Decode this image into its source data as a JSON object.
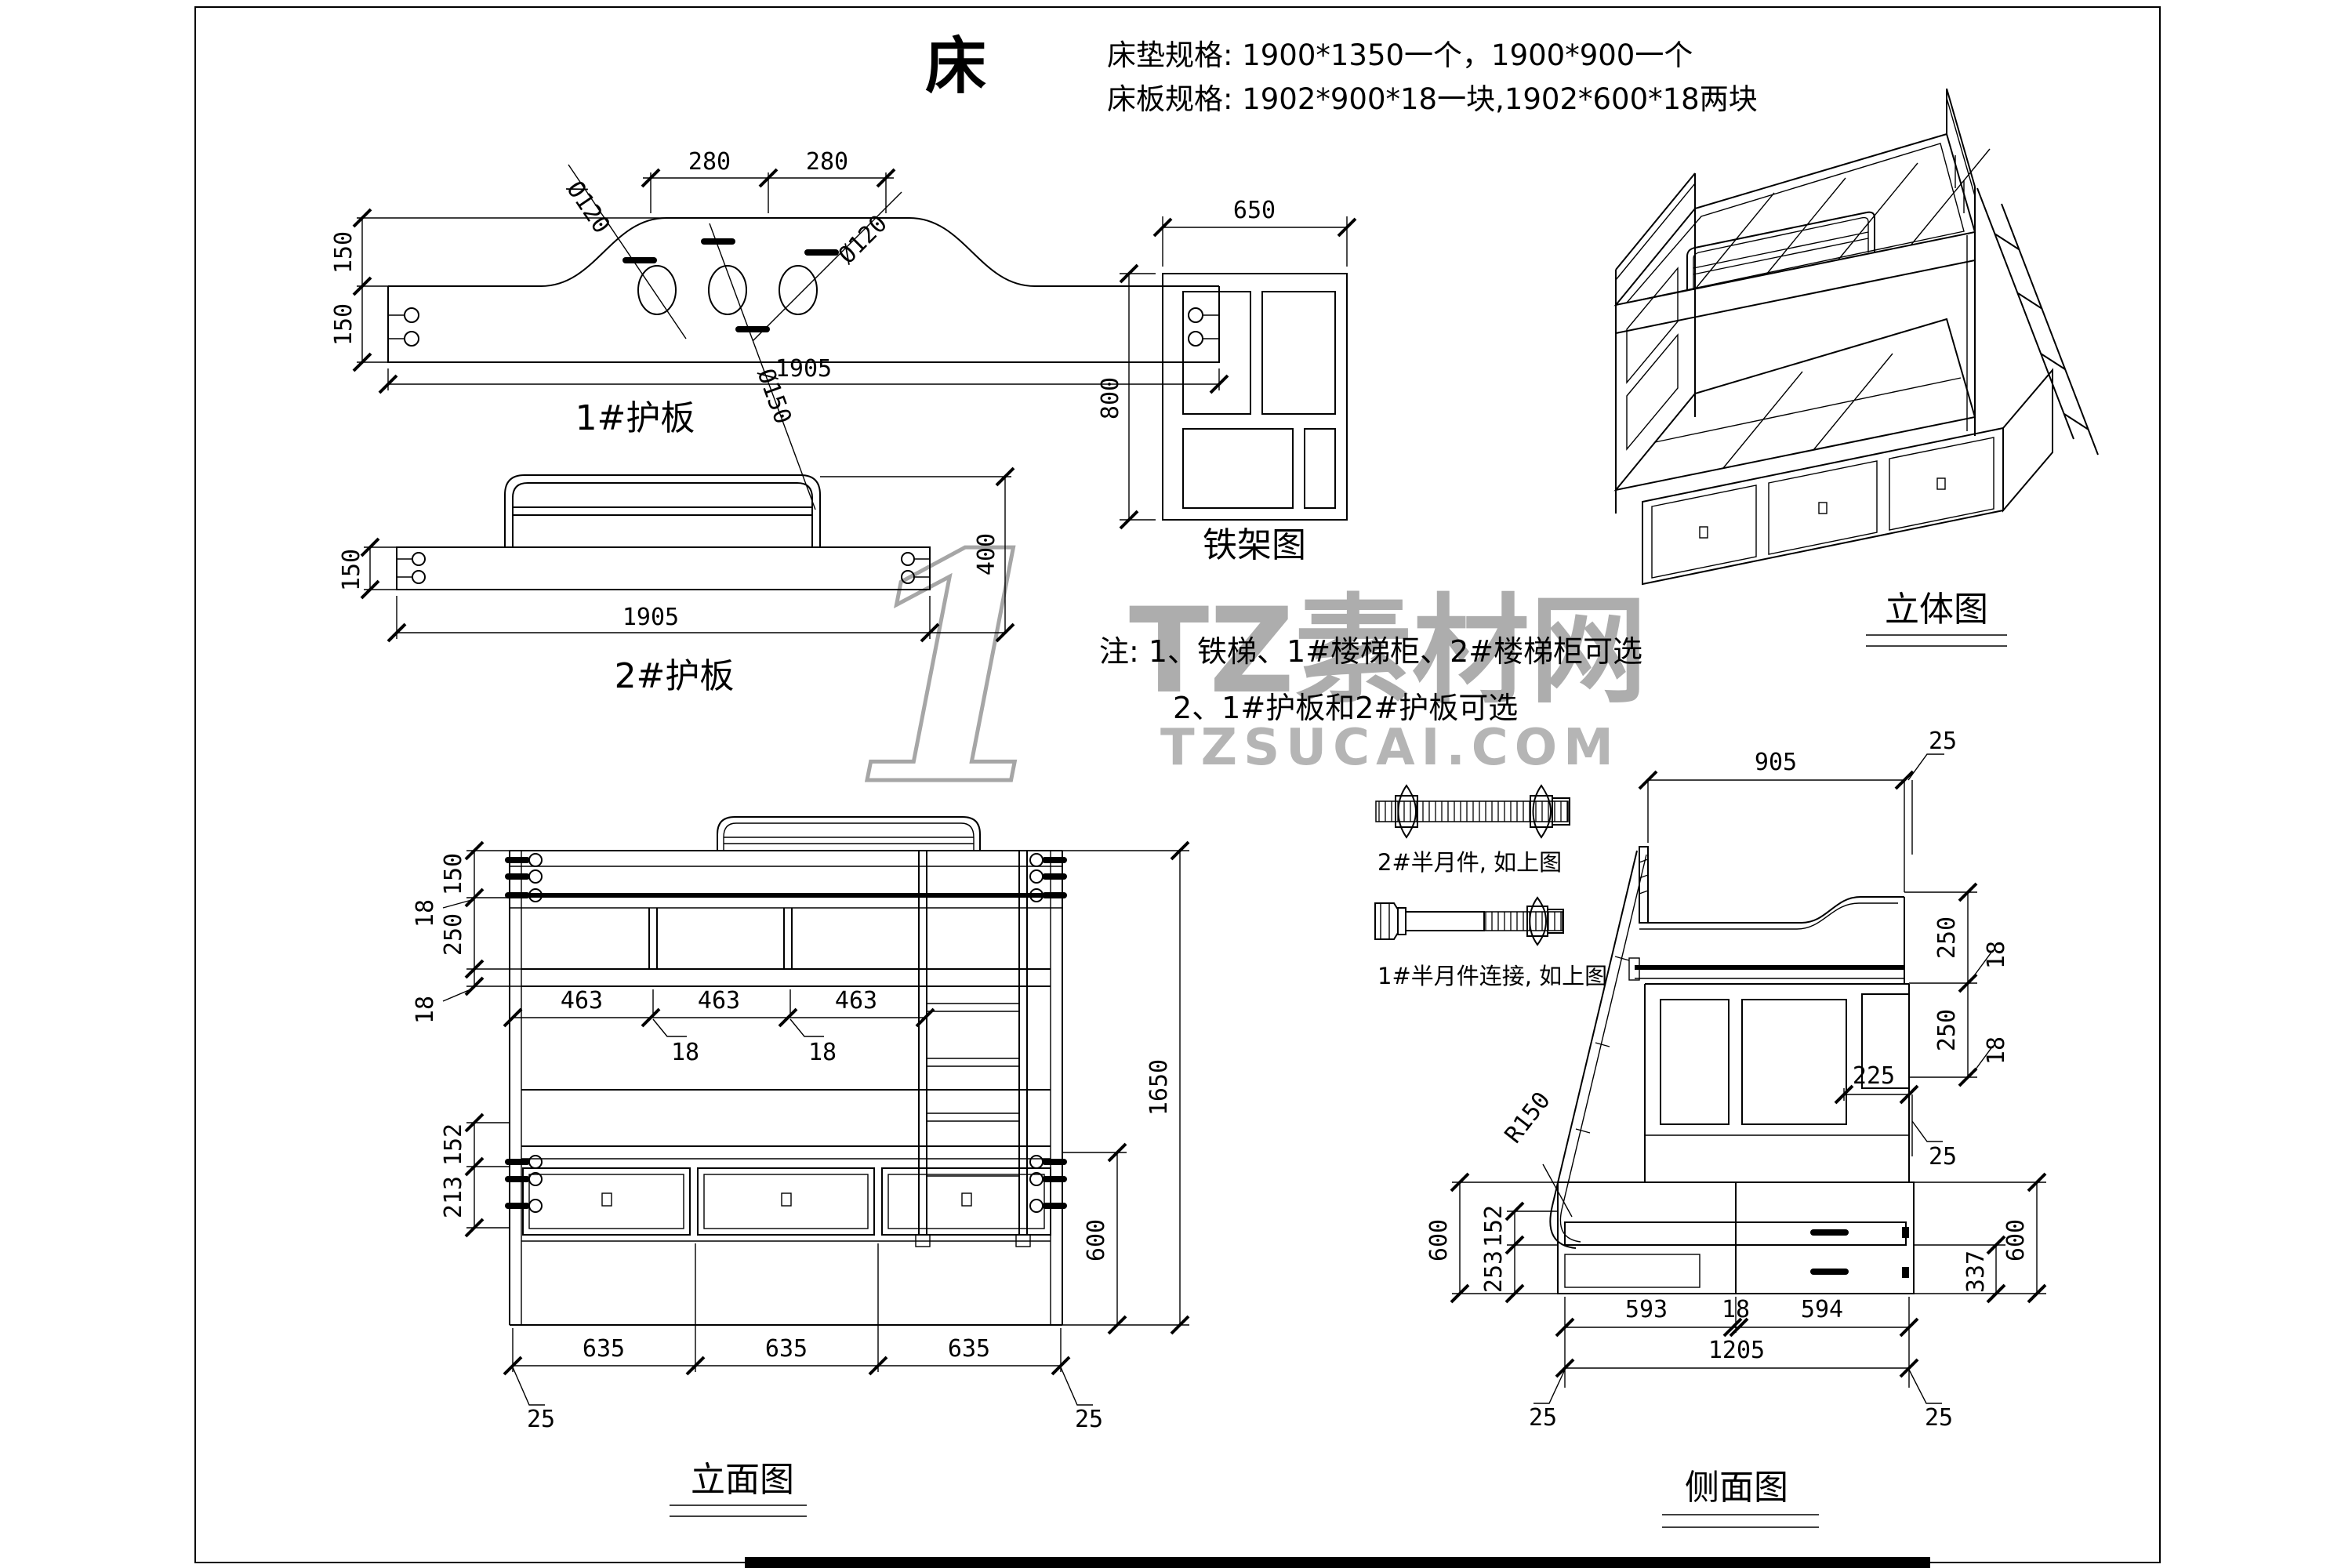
{
  "page": {
    "title": "床",
    "line_color": "#000000",
    "background": "#ffffff"
  },
  "specs": {
    "line1": "床垫规格: 1900*1350一个，1900*900一个",
    "line2": "床板规格: 1902*900*18一块,1902*600*18两块"
  },
  "notes": {
    "line1": "注: 1、铁梯、1#楼梯柜、2#楼梯柜可选",
    "line2": "2、1#护板和2#护板可选"
  },
  "watermark": {
    "numeral": "1",
    "brand": "TZ素材网",
    "site": "TZSUCAI.COM",
    "color": "#adadad"
  },
  "guard1": {
    "label": "1#护板",
    "dim_280_left": "280",
    "dim_280_right": "280",
    "dia_120_left": "Ø120",
    "dia_120_right": "Ø120",
    "dia_150": "Ø150",
    "dim_150_upper": "150",
    "dim_150_lower": "150",
    "dim_length": "1905"
  },
  "guard2": {
    "label": "2#护板",
    "dim_150": "150",
    "dim_400": "400",
    "dim_length": "1905"
  },
  "frame": {
    "label": "铁架图",
    "dim_width": "650",
    "dim_height": "800"
  },
  "iso": {
    "label": "立体图"
  },
  "front": {
    "label": "立面图",
    "d150": "150",
    "d18a": "18",
    "d250": "250",
    "d18b": "18",
    "d152": "152",
    "d213": "213",
    "d463a": "463",
    "d463b": "463",
    "d463c": "463",
    "d18c": "18",
    "d18d": "18",
    "d635a": "635",
    "d635b": "635",
    "d635c": "635",
    "d25l": "25",
    "d25r": "25",
    "d1650": "1650",
    "d600": "600"
  },
  "side": {
    "label": "侧面图",
    "d905": "905",
    "d25top": "25",
    "d250a": "250",
    "d18a": "18",
    "d250b": "250",
    "d18b": "18",
    "d225": "225",
    "d25mid": "25",
    "r150": "R150",
    "d600l": "600",
    "d152": "152",
    "d253": "253",
    "d337": "337",
    "d600r": "600",
    "d593": "593",
    "d18c": "18",
    "d594": "594",
    "d1205": "1205",
    "d25l": "25",
    "d25r": "25"
  },
  "hardware": {
    "bolt2_label": "2#半月件, 如上图",
    "bolt1_label": "1#半月件连接, 如上图"
  }
}
